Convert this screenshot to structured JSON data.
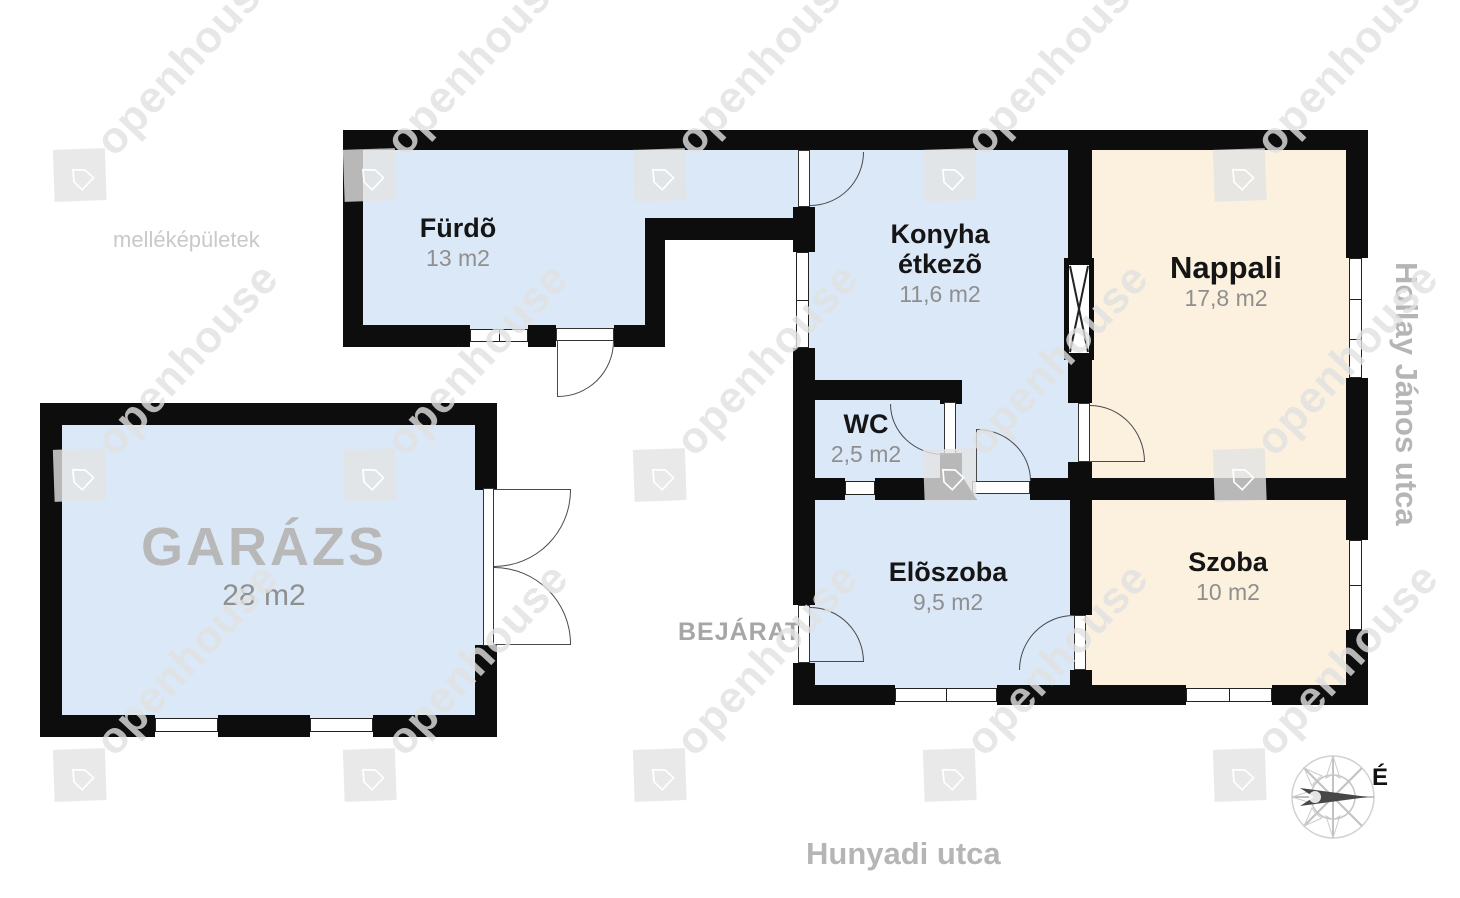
{
  "plan": {
    "rooms": {
      "furdo": {
        "name": "Fürdõ",
        "area": "13 m2"
      },
      "konyha": {
        "line1": "Konyha",
        "line2": "étkezõ",
        "area": "11,6 m2"
      },
      "nappali": {
        "name": "Nappali",
        "area": "17,8 m2"
      },
      "wc": {
        "name": "WC",
        "area": "2,5 m2"
      },
      "eloszoba": {
        "name": "Elõszoba",
        "area": "9,5 m2"
      },
      "szoba": {
        "name": "Szoba",
        "area": "10 m2"
      },
      "garazs": {
        "name": "GARÁZS",
        "area": "28 m2"
      }
    },
    "labels": {
      "outbuildings": "melléképületek",
      "entrance": "BEJÁRAT",
      "north": "É"
    },
    "streets": {
      "right": "Hollay János utca",
      "bottom": "Hunyadi utca"
    },
    "watermark": {
      "text": "openhouse"
    },
    "colors": {
      "room_blue": "#dbe8f7",
      "room_cream": "#fbf1de",
      "wall": "#0d0d0d",
      "street_text": "#b5b5b5"
    }
  }
}
